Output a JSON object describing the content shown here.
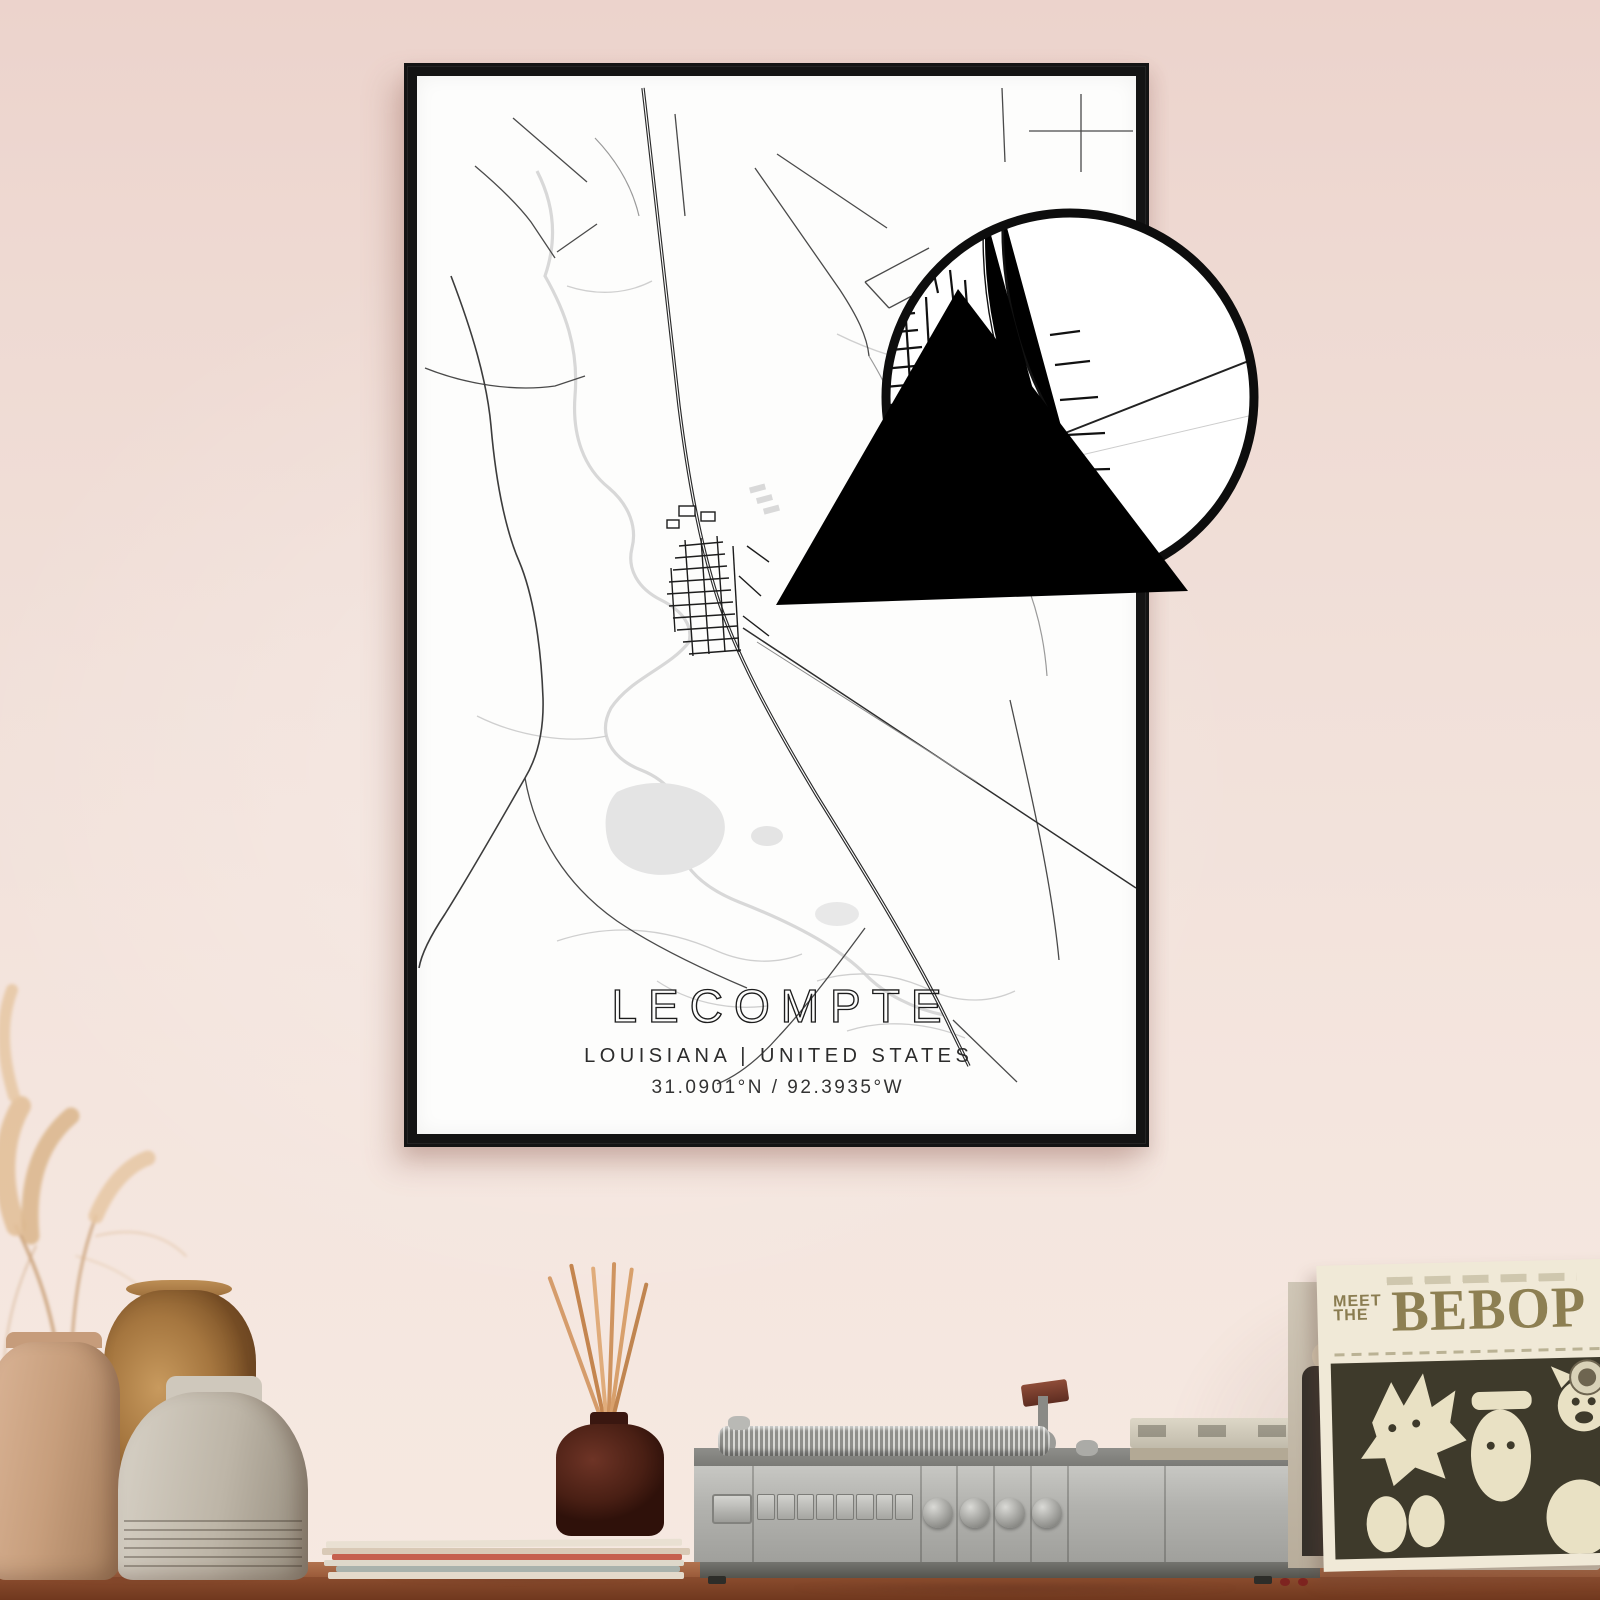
{
  "scene": {
    "description": "Framed black-and-white city map poster of Lecompte hanging on a pink wall above a wooden shelf with dried pampas grass in vases, a reed diffuser on magazines, a vintage record player and a record sleeve",
    "wall_color": "#f1e0d9",
    "shelf_wood_color": "#8a4c2e"
  },
  "poster": {
    "title": "LECOMPTE",
    "subtitle": "LOUISIANA | UNITED STATES",
    "coordinates": "31.0901°N / 92.3935°W",
    "frame_color": "#141414",
    "paper_color": "#fdfdfc",
    "road_color": "#2a2a2a",
    "water_color": "#d8d8d8",
    "magnifier": {
      "shape": "circle with triangle pointer",
      "border_color": "#0d0d0d",
      "content": "magnified street grid of the town center"
    }
  },
  "album": {
    "pretitle_line1": "MEET",
    "pretitle_line2": "THE",
    "title": "BEBOP",
    "cover_background": "#f0e9d7",
    "artwork_color": "#3e3a2b"
  }
}
